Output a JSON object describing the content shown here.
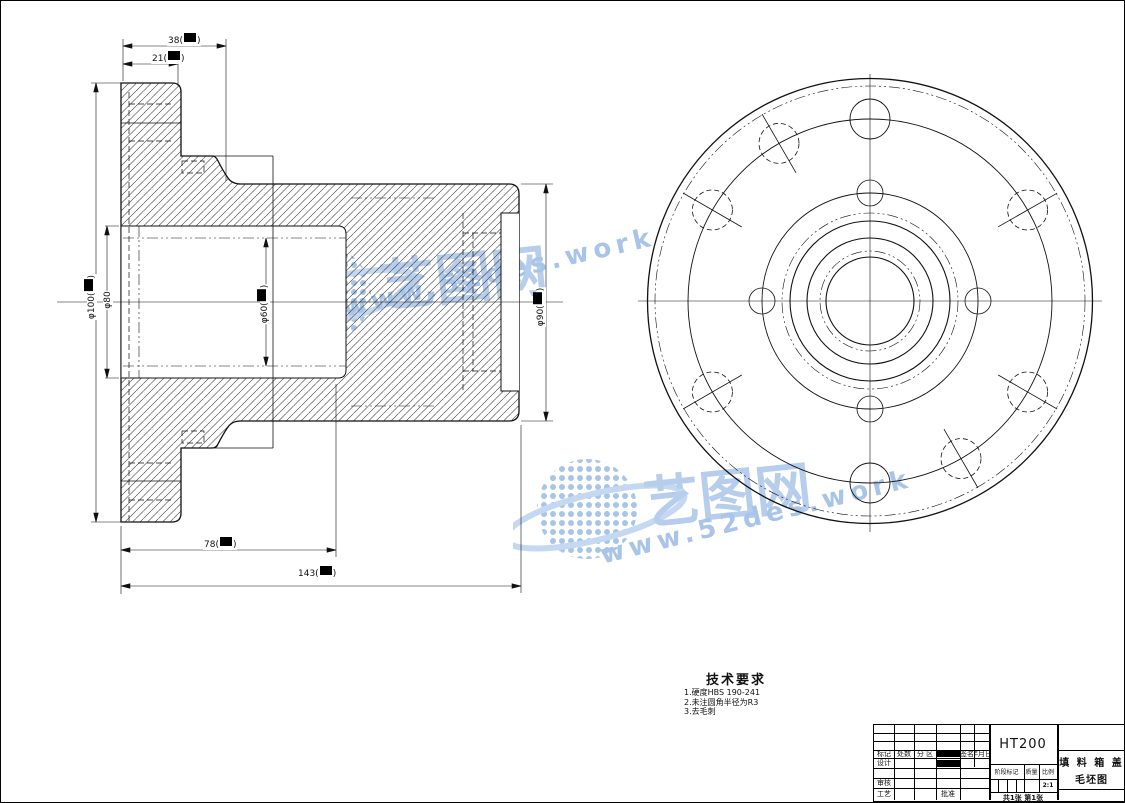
{
  "watermark": {
    "brand": "艺图网",
    "url": "www.52des.work",
    "color": "#b4cbea"
  },
  "tech": {
    "title": "技术要求",
    "items": [
      "1.硬度HBS 190-241",
      "2.未注圆角半径为R3",
      "3.去毛刺"
    ]
  },
  "dimensions": {
    "top_outer": {
      "pre": "38(",
      "post": ")"
    },
    "top_inner": {
      "pre": "21(",
      "post": ")"
    },
    "bottom_inner": {
      "pre": "78(",
      "post": ")"
    },
    "bottom_outer": {
      "pre": "143(",
      "post": ")"
    },
    "left_outer": {
      "pre": "φ100(",
      "post": ")"
    },
    "left_inner": {
      "pre": "φ80",
      "post": ""
    },
    "mid_bore": {
      "pre": "φ60(",
      "post": ")"
    },
    "right_od": {
      "pre": "φ90(",
      "post": ")"
    }
  },
  "title_block": {
    "material": "HT200",
    "part_name": "填 料 箱 盖",
    "drawing_type": "毛坯图",
    "header_row": [
      "标记",
      "处数",
      "分 区",
      "签名",
      "年月日"
    ],
    "design": "设计",
    "review": "审核",
    "process": "工艺",
    "approve": "批准",
    "stage_mark": "阶段标记",
    "weight": "质量",
    "scale": "比例",
    "scale_value": "2:1",
    "sheet_info": "共1张 第1张"
  }
}
